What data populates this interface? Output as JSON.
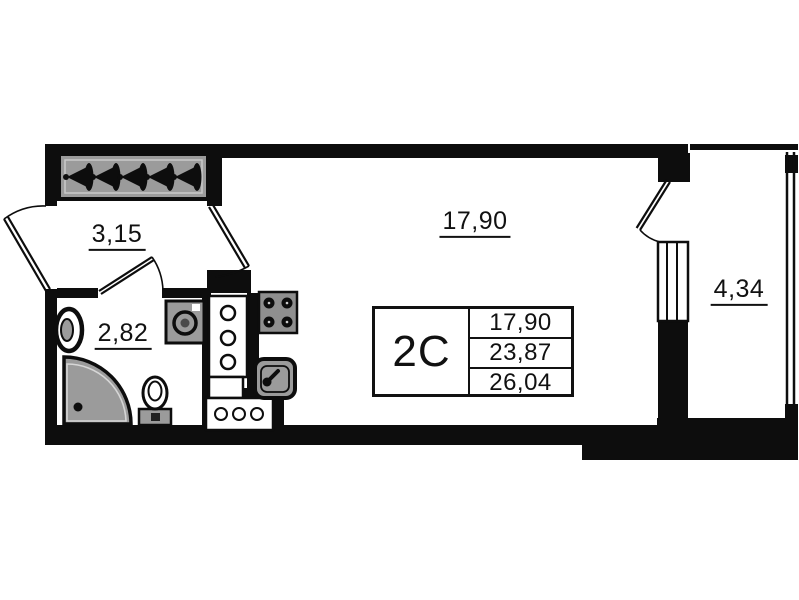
{
  "plan": {
    "title": "studio apartment floor plan",
    "rooms": {
      "hallway": {
        "label": "3,15"
      },
      "bathroom": {
        "label": "2,82"
      },
      "living_room": {
        "label": "17,90"
      },
      "balcony": {
        "label": "4,34"
      }
    },
    "info_table": {
      "unit_type": "2C",
      "values": [
        "17,90",
        "23,87",
        "26,04"
      ]
    },
    "colors": {
      "wall": "#0d0d0d",
      "fixture_fill": "#9b9b9b",
      "stove_fill": "#8f8f8f",
      "background": "#ffffff",
      "text": "#111111"
    },
    "fixtures": [
      "wardrobe-hangers",
      "entrance-door",
      "bathroom-door",
      "living-room-door",
      "balcony-door",
      "balcony-window",
      "balcony-glazing",
      "bathroom-sink",
      "shower-tray",
      "toilet",
      "washing-machine",
      "kitchen-tall-cabinet",
      "kitchen-base-cabinet",
      "kitchen-counter",
      "stove",
      "kitchen-sink"
    ]
  }
}
